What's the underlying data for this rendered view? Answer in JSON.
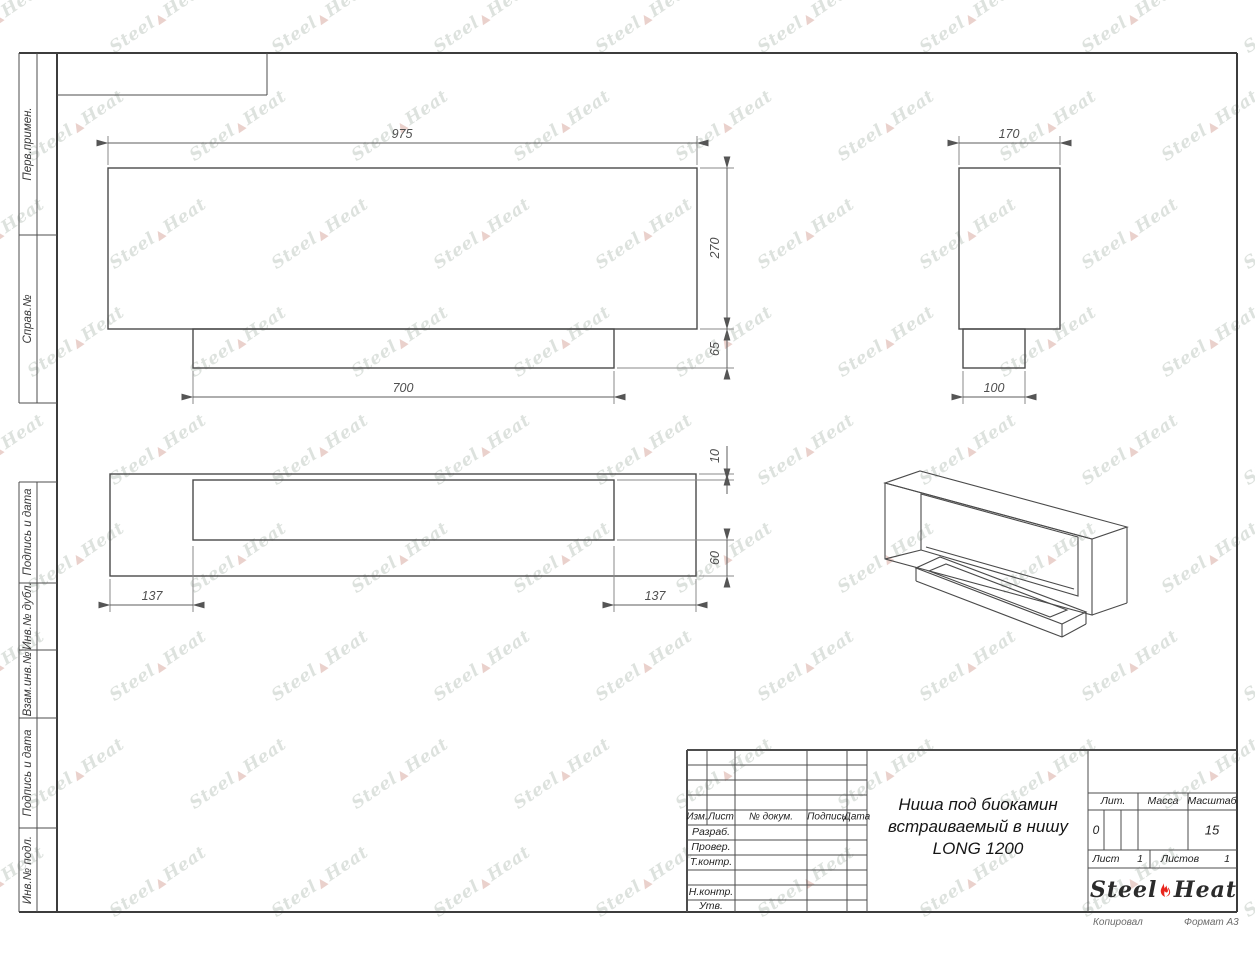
{
  "watermark": {
    "word1": "Steel",
    "word2": "Heat"
  },
  "sidebar": {
    "cells_top": [
      "Перв.примен.",
      "Справ.№"
    ],
    "cells_bottom": [
      "Подпись и дата",
      "Инв.№ дубл.",
      "Взам.инв.№",
      "Подпись и дата",
      "Инв.№ подл."
    ]
  },
  "views": {
    "front": {
      "dim_width": "975",
      "dim_height": "270",
      "dim_step_height": "65",
      "dim_step_width": "700"
    },
    "side": {
      "dim_width": "170",
      "dim_step_width": "100"
    },
    "bottom": {
      "dim_top_inset": "10",
      "dim_bottom_inset": "60",
      "dim_left_inset": "137",
      "dim_right_inset": "137"
    }
  },
  "title_block": {
    "revision_headers": [
      "Изм.",
      "Лист",
      "№ докум.",
      "Подпись",
      "Дата"
    ],
    "staff_labels": [
      "Разраб.",
      "Провер.",
      "Т.контр.",
      "Н.контр.",
      "Утв."
    ],
    "title_lines": [
      "Ниша под биокамин",
      "встраиваемый в нишу",
      "LONG 1200"
    ],
    "lit_label": "Лит.",
    "lit_value": "0",
    "mass_label": "Масса",
    "scale_label": "Масштаб",
    "scale_value": "15",
    "sheet_label": "Лист",
    "sheet_number": "1",
    "sheets_label": "Листов",
    "sheets_total": "1",
    "brand_word1": "Steel",
    "brand_word2": "Heat"
  },
  "footer": {
    "copied": "Копировал",
    "format": "Формат А3"
  }
}
